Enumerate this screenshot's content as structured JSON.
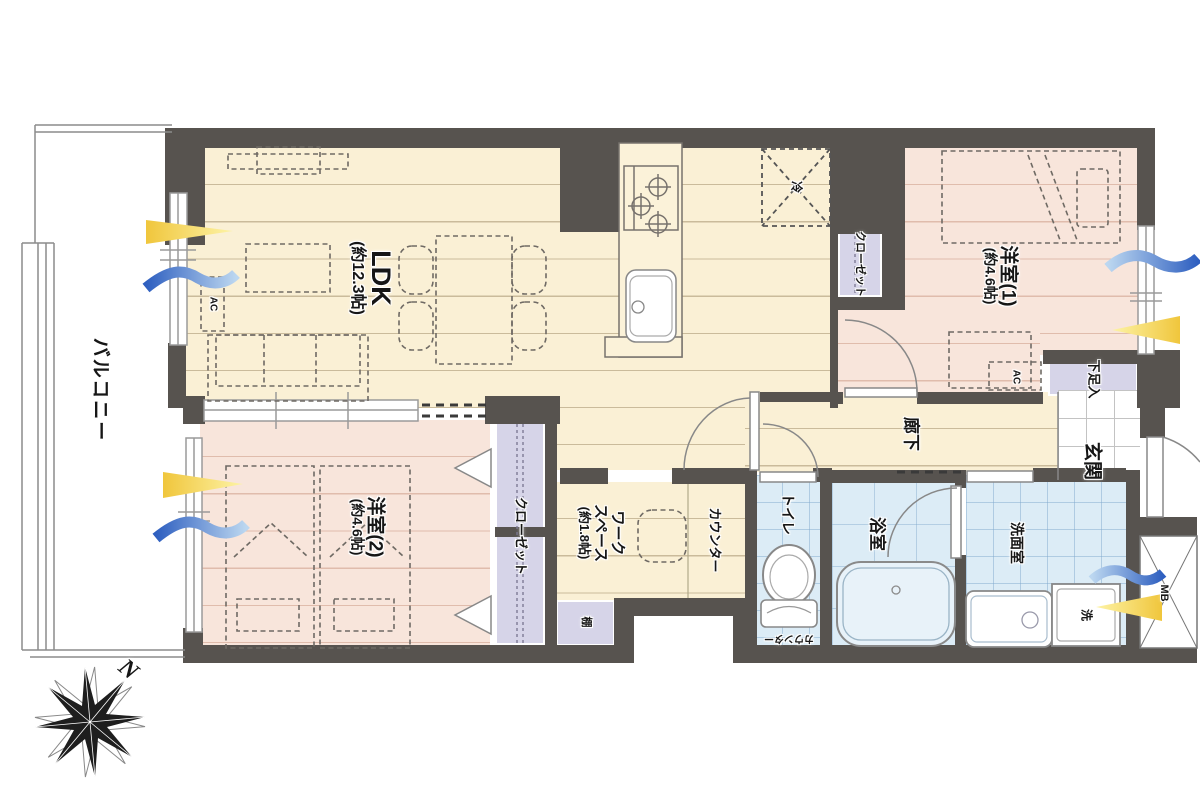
{
  "floorplan": {
    "balcony": "バルコニー",
    "ldk": {
      "name": "LDK",
      "size": "(約12.3帖)",
      "ac": "AC"
    },
    "kitchen": {
      "fridge": "冷",
      "closet": "クローゼット"
    },
    "bedroom1": {
      "name": "洋室(1)",
      "size": "(約4.6帖)",
      "ac": "AC"
    },
    "bedroom2": {
      "name": "洋室(2)",
      "size": "(約4.6帖)",
      "closet": "クローゼット"
    },
    "workspace": {
      "line1": "ワーク",
      "line2": "スペース",
      "size": "(約1.8帖)",
      "counter": "カウンター",
      "shelf": "棚"
    },
    "hallway": "廊下",
    "entrance": {
      "name": "玄関",
      "shoe_storage": "下足入"
    },
    "toilet": {
      "name": "トイレ",
      "counter": "カウンター"
    },
    "bathroom": "浴室",
    "washroom": {
      "name": "洗面室",
      "washer": "洗"
    },
    "meter_box": "MB",
    "compass_north": "N"
  },
  "colors": {
    "wall": "#57534f",
    "floor_wood": "#faf0d5",
    "floor_pink": "#f8e5db",
    "floor_wet": "#dcecf6",
    "closet": "#d6d4e8",
    "light_arrow": "#f0c63c",
    "wind_arrow": "#2e5fc0"
  }
}
